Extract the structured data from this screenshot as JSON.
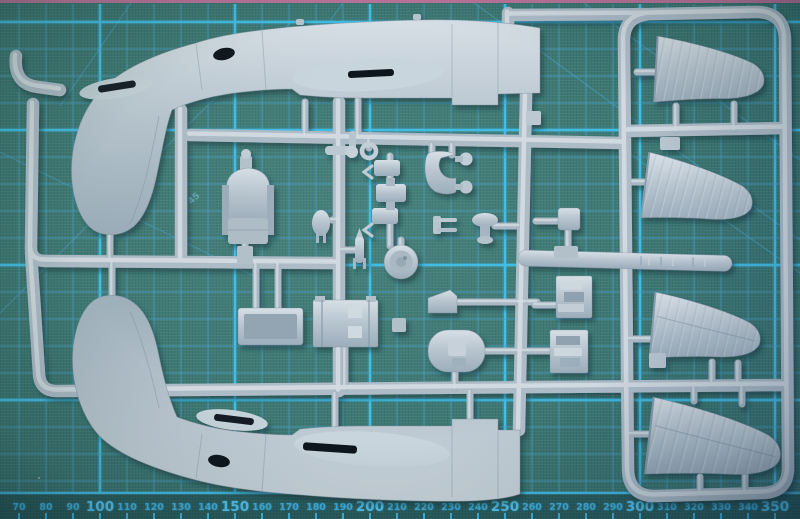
{
  "scene": {
    "title": "Model aircraft sprue on cutting mat",
    "description": "Light grey injection-moulded aircraft model sprue (two fuselage halves, four outer wing panels and many small cockpit and engine parts) photographed lying on a teal self-healing cutting mat with printed blue grid and millimetre ruler"
  },
  "mat": {
    "colors": {
      "surface": "#3a7571",
      "grid_minor": "#4aa4ce",
      "grid_major": "#41c2ee",
      "ruler_line": "#45c0ee",
      "border_pink": "#c9739f",
      "label_minor": "#3fb2e2",
      "label_major": "#54c4f0"
    },
    "grid": {
      "x0": 19,
      "y0": 22,
      "minor_spacing": 27,
      "major_vertical_index_mod5": 3,
      "major_horizontal_index_mod5": 4,
      "top_border_y": 22,
      "baseline_y": 493
    },
    "ruler": {
      "unit": "mm",
      "start": 70,
      "end": 350,
      "step": 10,
      "major_multiple": 50,
      "px_per_unit": 2.7,
      "x_of_100": 100
    },
    "angle_label": "45",
    "diagonals": [
      [
        133,
        0,
        60,
        106
      ],
      [
        0,
        313,
        290,
        23
      ],
      [
        0,
        152,
        262,
        280
      ],
      [
        470,
        0,
        800,
        240
      ],
      [
        580,
        0,
        800,
        160
      ],
      [
        620,
        147,
        800,
        273
      ],
      [
        345,
        0,
        330,
        21
      ]
    ],
    "dust_specks": [
      [
        38,
        477
      ],
      [
        118,
        121
      ],
      [
        688,
        341
      ],
      [
        262,
        56
      ]
    ]
  },
  "sprue": {
    "material": "light grey polystyrene",
    "colors": {
      "plastic": "#b2c0cb",
      "plastic_light": "#dce3e9",
      "plastic_dark": "#8093a1",
      "slot_dark": "#121a26"
    },
    "parts": [
      "fuselage half (upper)",
      "fuselage half (lower)",
      "outer wing panel 1",
      "outer wing panel 2",
      "outer wing panel 3",
      "outer wing panel 4",
      "pilot seat with headrest",
      "engine / wheel disc",
      "cowling horseshoe fitting",
      "cylinder blocks",
      "drop bomb",
      "small rocket",
      "sight ring",
      "propeller hub cross",
      "cockpit floor tray",
      "cockpit bulkhead",
      "oval access panel",
      "engine block upper",
      "engine block lower",
      "anvil fitting",
      "fork fitting",
      "square fitting with base",
      "nose block"
    ]
  }
}
